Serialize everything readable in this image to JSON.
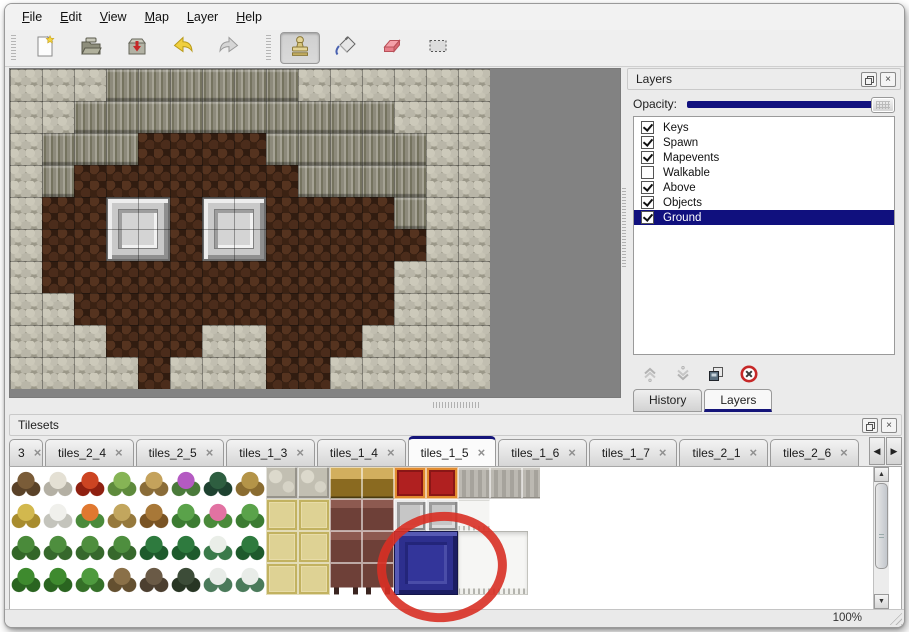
{
  "menu_bar": {
    "items": [
      "File",
      "Edit",
      "View",
      "Map",
      "Layer",
      "Help"
    ]
  },
  "toolbar": {
    "file_buttons": [
      {
        "name": "new-file",
        "icon": "new-file-icon"
      },
      {
        "name": "open",
        "icon": "open-folder-icon"
      },
      {
        "name": "save",
        "icon": "save-icon"
      },
      {
        "name": "undo",
        "icon": "undo-arrow-icon"
      },
      {
        "name": "redo",
        "icon": "redo-arrow-icon"
      }
    ],
    "tool_buttons": [
      {
        "name": "stamp-tool",
        "icon": "stamp-icon",
        "active": true
      },
      {
        "name": "fill-tool",
        "icon": "paint-bucket-icon",
        "active": false
      },
      {
        "name": "eraser-tool",
        "icon": "eraser-icon",
        "active": false
      },
      {
        "name": "select-tool",
        "icon": "selection-rect-icon",
        "active": false
      }
    ]
  },
  "map_view": {
    "tile_size": 32,
    "legend": {
      "W": "wall-top",
      "F": "wall-face",
      "G": "ground"
    },
    "grid_rows": [
      "WWWFFFFFFWWWWWW",
      "WWFFFFFFFFFFWWW",
      "WFFFGGGGFFFFFWW",
      "WFGGGGGGGFFFFWW",
      "WGGGGGGGGGGGFWW",
      "WGGGGGGGGGGGGWW",
      "WGGGGGGGGGGGWWW",
      "WWGGGGGGGGGGWWW",
      "WWWGGGWWGGGWWWW",
      "WWWWGWWWGGWWWWW"
    ],
    "pedestals": [
      {
        "col": 3,
        "row": 4,
        "w": 2,
        "h": 2
      },
      {
        "col": 6,
        "row": 4,
        "w": 2,
        "h": 2
      }
    ]
  },
  "layers_panel": {
    "title": "Layers",
    "title_buttons": [
      "float-icon",
      "close-icon"
    ],
    "opacity_label": "Opacity:",
    "opacity_percent": 100,
    "layers": [
      {
        "name": "Keys",
        "checked": true,
        "selected": false
      },
      {
        "name": "Spawn",
        "checked": true,
        "selected": false
      },
      {
        "name": "Mapevents",
        "checked": true,
        "selected": false
      },
      {
        "name": "Walkable",
        "checked": false,
        "selected": false
      },
      {
        "name": "Above",
        "checked": true,
        "selected": false
      },
      {
        "name": "Objects",
        "checked": true,
        "selected": false
      },
      {
        "name": "Ground",
        "checked": true,
        "selected": true
      }
    ],
    "action_icons": [
      "move-up-icon",
      "move-down-icon",
      "duplicate-layer-icon",
      "delete-layer-icon"
    ],
    "tabs": [
      {
        "label": "History",
        "active": false
      },
      {
        "label": "Layers",
        "active": true
      }
    ]
  },
  "tilesets_panel": {
    "title": "Tilesets",
    "title_buttons": [
      "float-icon",
      "close-icon"
    ],
    "tabs": [
      {
        "label": "3",
        "active": false,
        "clipped": true
      },
      {
        "label": "tiles_2_4",
        "active": false
      },
      {
        "label": "tiles_2_5",
        "active": false
      },
      {
        "label": "tiles_1_3",
        "active": false
      },
      {
        "label": "tiles_1_4",
        "active": false
      },
      {
        "label": "tiles_1_5",
        "active": true
      },
      {
        "label": "tiles_1_6",
        "active": false
      },
      {
        "label": "tiles_1_7",
        "active": false
      },
      {
        "label": "tiles_2_1",
        "active": false
      },
      {
        "label": "tiles_2_6",
        "active": false
      }
    ],
    "scroll_buttons": [
      "tab-scroll-left-icon",
      "tab-scroll-right-icon"
    ],
    "tileset_grid": [
      [
        "tree-bare",
        "tree-white",
        "flower-red",
        "stump",
        "trunk",
        "bush-purple",
        "fern-dark",
        "twig",
        "stone",
        "stone",
        "table-gold",
        "table-gold",
        "carpet-red",
        "carpet-red",
        "fabric-gray",
        "fabric-gray",
        "fabric-gray"
      ],
      [
        "mound-yellow",
        "mound-snow",
        "flowers-orange",
        "grass-dry",
        "leaves",
        "lily-pad",
        "flowers-pink",
        "lily-pad",
        "mat-tan",
        "mat-tan",
        "table-maroon",
        "table-maroon",
        "block-silver",
        "block-silver",
        "curtain-white",
        "blank",
        "blank"
      ],
      [
        "sprouts",
        "bush-green",
        "bush-green",
        "bush-green",
        "palm",
        "palm",
        "palm-snow",
        "palm",
        "mat-tan",
        "mat-tan",
        "table-maroon",
        "table-maroon",
        "blank",
        "blank",
        "blank",
        "blank",
        "blank"
      ],
      [
        "pine-green",
        "pine-green",
        "tree-green",
        "tree-twisted",
        "tree-dead",
        "tree-dark",
        "pine-snow",
        "pine-snow",
        "mat-tan",
        "mat-tan",
        "table-maroon-legs",
        "table-maroon-legs",
        "blank",
        "blank",
        "blank",
        "blank",
        "blank"
      ]
    ],
    "overlays": [
      {
        "type": "blue-block",
        "col": 12,
        "row": 2,
        "w": 2,
        "h": 2
      },
      {
        "type": "curtain-block",
        "col": 14,
        "row": 2,
        "w": 2.2,
        "h": 2
      }
    ],
    "annotation": {
      "shape": "red-circle",
      "color": "#d93025"
    }
  },
  "status_bar": {
    "zoom": "100%"
  },
  "colors": {
    "selection_navy": "#10107e",
    "opacity_fill": "#10107e",
    "active_tab_accent": "#15157a",
    "annotation_red": "#d93025",
    "blue_tile": "#2d2f8e"
  }
}
